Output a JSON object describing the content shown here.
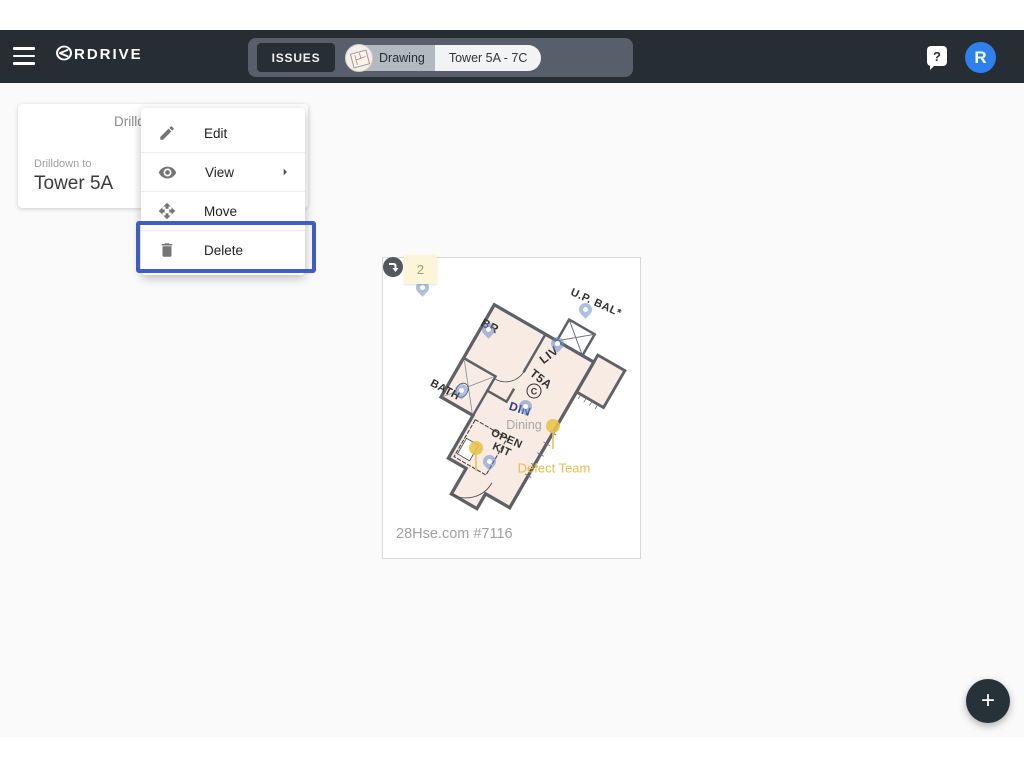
{
  "navbar": {
    "logo_text": "RDRIVE",
    "issues_button": "ISSUES",
    "chip": {
      "type_label": "Drawing",
      "name": "Tower 5A - 7C"
    },
    "help_label": "?",
    "avatar_letter": "R"
  },
  "card": {
    "title": "Drilldown",
    "subtitle": "Drilldown to",
    "name": "Tower 5A"
  },
  "menu": {
    "items": [
      {
        "label": "Edit",
        "icon": "pencil-icon"
      },
      {
        "label": "View",
        "icon": "eye-icon",
        "has_submenu": true
      },
      {
        "label": "Move",
        "icon": "move-icon"
      },
      {
        "label": "Delete",
        "icon": "trash-icon",
        "highlighted": true
      }
    ],
    "highlight_color": "#3f5dc7"
  },
  "plan": {
    "note_value": "2",
    "rooms": {
      "br": "BR",
      "upbal": "U.P. BAL*",
      "liv": "LIV",
      "t5a": "T5A",
      "c": "C",
      "din": "DIN",
      "bath": "BATH",
      "openkit_line1": "OPEN",
      "openkit_line2": "KIT"
    },
    "annotations": {
      "dining": "Dining",
      "defect_team": "Defect Team"
    },
    "watermark": "28Hse.com #7116"
  },
  "fab": {
    "label": "+"
  },
  "colors": {
    "navbar_bg": "#262d33",
    "toolbar_bg": "#57606a",
    "brand_blue": "#2f80ef",
    "highlight_ring": "#3f5dc7",
    "plan_fill": "#f8ebe4",
    "pin_blue": "#688cc8",
    "pin_yellow": "#e9c348",
    "content_bg": "#fafafa"
  }
}
